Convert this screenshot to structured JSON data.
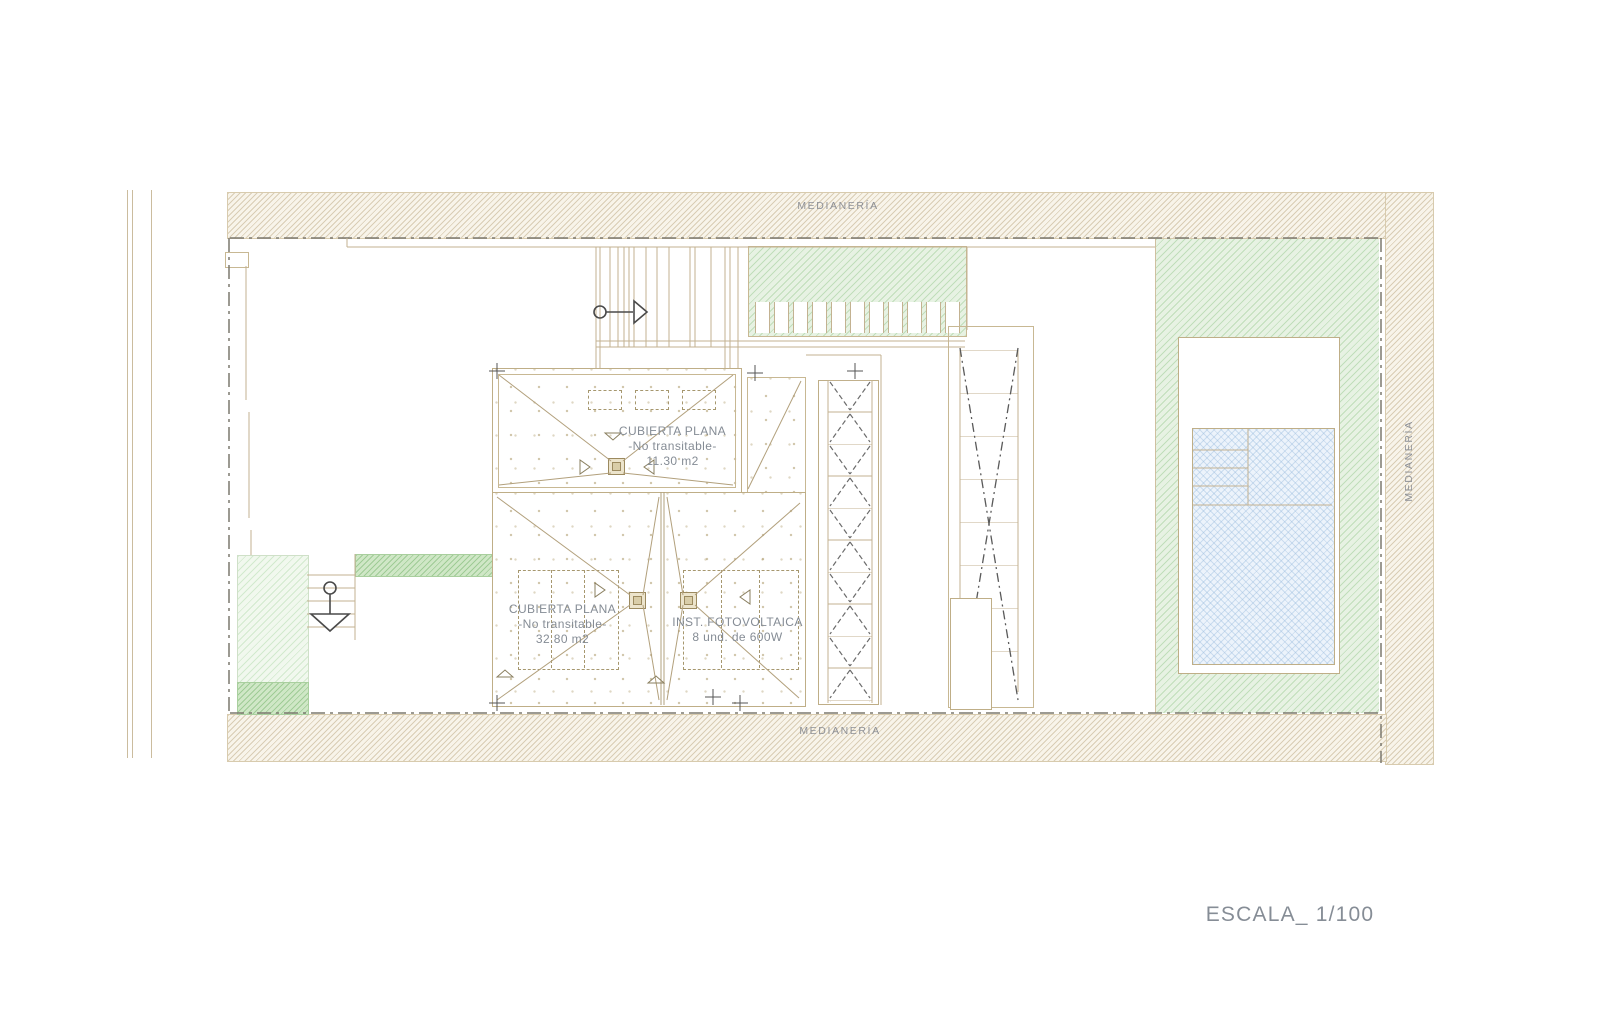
{
  "drawing": {
    "scale_label": "ESCALA_ 1/100",
    "party_wall_top": "MEDIANERÍA",
    "party_wall_bottom": "MEDIANERÍA",
    "party_wall_right": "MEDIANERÍA",
    "roof_upper": {
      "line1": "CUBIERTA PLANA",
      "line2": "-No transitable-",
      "line3": "11.30 m2"
    },
    "roof_lower": {
      "line1": "CUBIERTA PLANA",
      "line2": "-No transitable-",
      "line3": "32.80 m2"
    },
    "photovoltaic": {
      "line1": "INST. FOTOVOLTAICA",
      "line2": "8 und. de 600W"
    },
    "colors": {
      "line_tan": "#c3b291",
      "party_wall_hatch_bg": "#f8f4ea",
      "garden_green": "#e7f2e3",
      "dark_green": "#cfe7c6",
      "pool_blue": "#ecf3fb",
      "annotation_gray": "#858c95",
      "boundary_gray": "#7b786e"
    }
  }
}
